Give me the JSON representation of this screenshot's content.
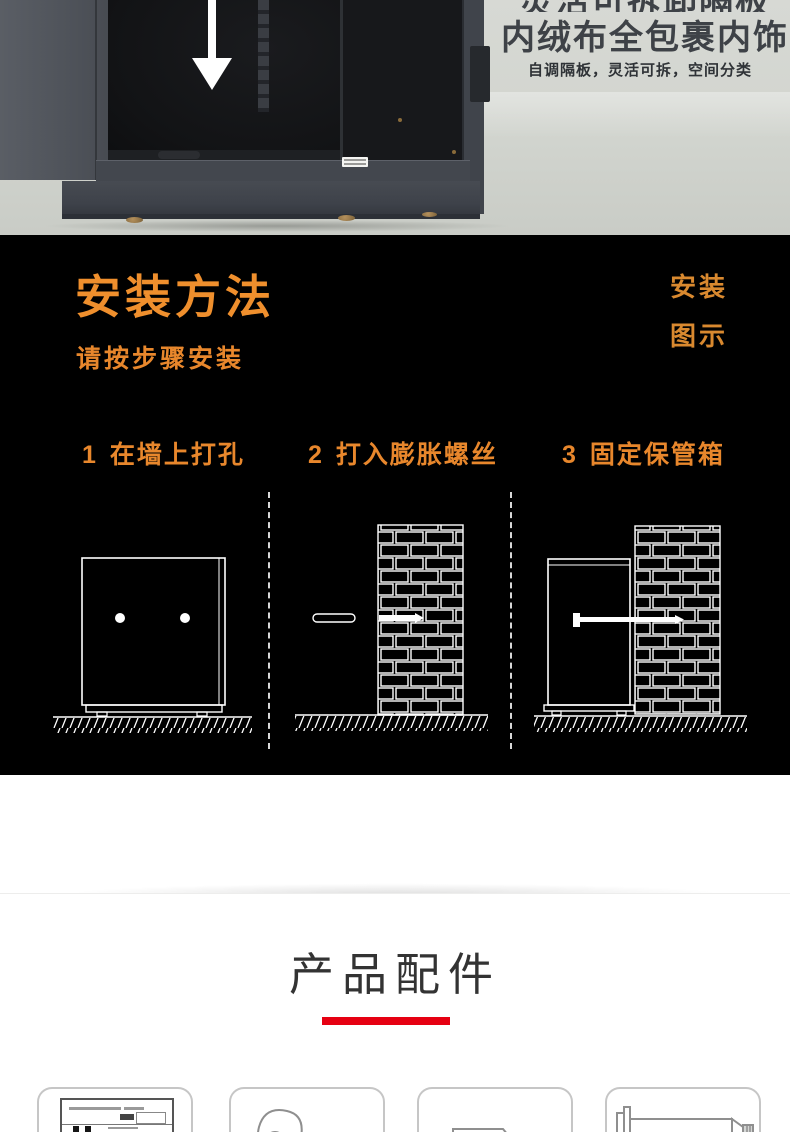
{
  "hero": {
    "headline_line1": "灵活可拆卸隔板",
    "headline_line2": "内绒布全包裹内饰",
    "subline": "自调隔板，灵活可拆，空间分类"
  },
  "install": {
    "title": "安装方法",
    "subtitle": "请按步骤安装",
    "side_label_top": "安装",
    "side_label_bottom": "图示",
    "accent_color": "#ef8f2d",
    "steps": [
      {
        "num": "1",
        "label": "在墙上打孔"
      },
      {
        "num": "2",
        "label": "打入膨胀螺丝"
      },
      {
        "num": "3",
        "label": "固定保管箱"
      }
    ],
    "diagram_icons": [
      "safe-with-drill-holes-icon",
      "expansion-bolt-into-brick-wall-icon",
      "safe-fixed-to-brick-wall-icon"
    ]
  },
  "accessories": {
    "title": "产品配件",
    "underline_color": "#e60012",
    "manual_title": "使用手册",
    "item_icons": [
      "user-manual-icon",
      "key-icon",
      "corner-bracket-icon",
      "expansion-bolt-icon"
    ]
  }
}
